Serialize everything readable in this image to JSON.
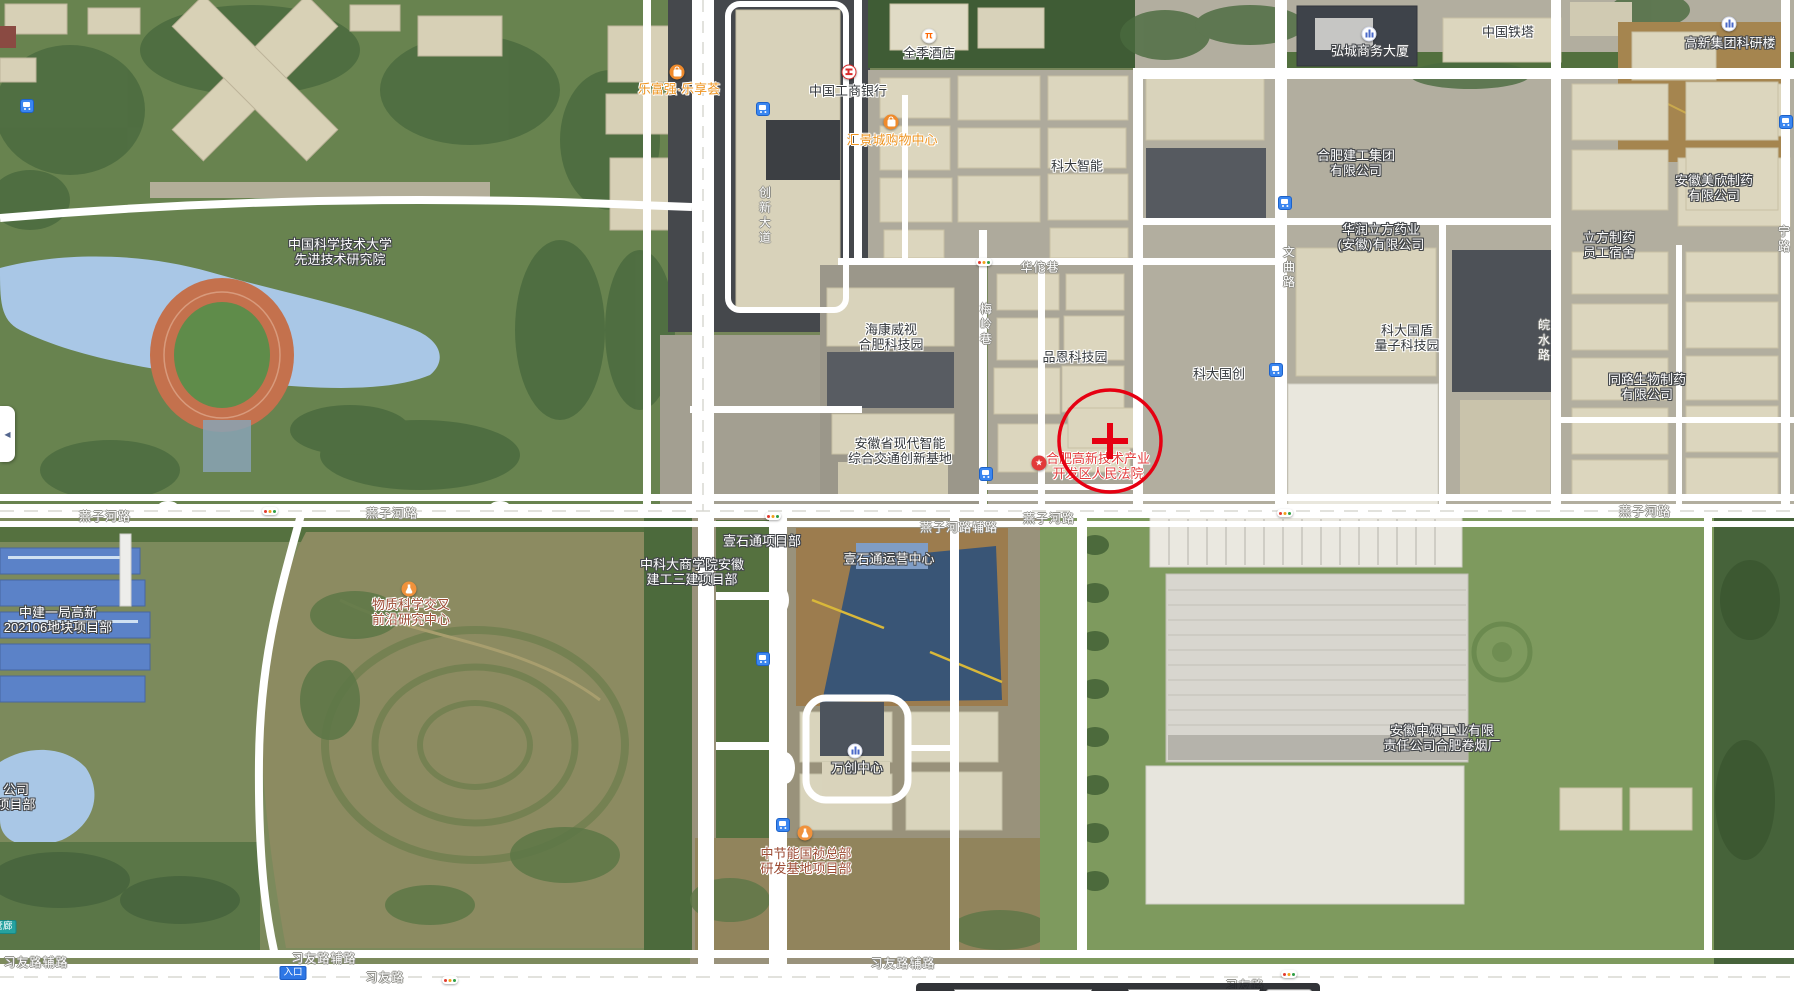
{
  "map": {
    "controls": {
      "collapse_arrow": "◀"
    },
    "marker": {
      "x": 1110,
      "y": 441,
      "r": 51
    },
    "bottom_bar": {
      "lng_label": "经度",
      "lng_value": "117.1978979979597",
      "lat_label": "纬度",
      "lat_value": "31.82598845471594",
      "search_button": "查询"
    },
    "pois": [
      {
        "id": "lefuqiang-mall",
        "lines": [
          "乐富强·乐享荟"
        ],
        "x": 679,
        "y": 89,
        "color": "orange",
        "icon": "shopping",
        "icon_x": 677,
        "icon_y": 72
      },
      {
        "id": "quanji-hotel",
        "lines": [
          "全季酒店"
        ],
        "x": 929,
        "y": 53,
        "color": "dark",
        "icon": "hotel",
        "icon_x": 929,
        "icon_y": 36
      },
      {
        "id": "icbc-bank",
        "lines": [
          "中国工商银行"
        ],
        "x": 848,
        "y": 91,
        "color": "dark",
        "icon": "bank",
        "icon_x": 849,
        "icon_y": 72
      },
      {
        "id": "huijing-mall",
        "lines": [
          "汇景城购物中心"
        ],
        "x": 892,
        "y": 140,
        "color": "orange",
        "icon": "shopping",
        "icon_x": 891,
        "icon_y": 122
      },
      {
        "id": "keda-zhineng",
        "lines": [
          "科大智能"
        ],
        "x": 1077,
        "y": 166,
        "color": "dark"
      },
      {
        "id": "hongcheng-tower",
        "lines": [
          "弘城商务大厦"
        ],
        "x": 1370,
        "y": 51,
        "color": "white",
        "icon": "building",
        "icon_x": 1369,
        "icon_y": 34
      },
      {
        "id": "china-tower",
        "lines": [
          "中国铁塔"
        ],
        "x": 1508,
        "y": 32,
        "color": "dark"
      },
      {
        "id": "gaoxin-keyan-building",
        "lines": [
          "高新集团科研楼"
        ],
        "x": 1730,
        "y": 43,
        "color": "white",
        "icon": "building",
        "icon_x": 1729,
        "icon_y": 24
      },
      {
        "id": "hefei-jiangong-group",
        "lines": [
          "合肥建工集团",
          "有限公司"
        ],
        "x": 1356,
        "y": 163,
        "color": "white"
      },
      {
        "id": "huarun-lifang-pharma",
        "lines": [
          "华润立方药业",
          "(安徽)有限公司"
        ],
        "x": 1381,
        "y": 237,
        "color": "white"
      },
      {
        "id": "lifang-dormitory",
        "lines": [
          "立方制药",
          "员工宿舍"
        ],
        "x": 1609,
        "y": 245,
        "color": "white"
      },
      {
        "id": "meixin-pharma",
        "lines": [
          "安徽美欣制药",
          "有限公司"
        ],
        "x": 1714,
        "y": 188,
        "color": "white"
      },
      {
        "id": "ustc-institute",
        "lines": [
          "中国科学技术大学",
          "先进技术研究院"
        ],
        "x": 340,
        "y": 252,
        "color": "white"
      },
      {
        "id": "hikvision-park",
        "lines": [
          "海康威视",
          "合肥科技园"
        ],
        "x": 891,
        "y": 337,
        "color": "dark"
      },
      {
        "id": "pinen-tech-park",
        "lines": [
          "品恩科技园"
        ],
        "x": 1075,
        "y": 357,
        "color": "dark"
      },
      {
        "id": "keda-guochuang",
        "lines": [
          "科大国创"
        ],
        "x": 1219,
        "y": 374,
        "color": "dark"
      },
      {
        "id": "guodun-quantum-park",
        "lines": [
          "科大国盾",
          "量子科技园"
        ],
        "x": 1407,
        "y": 338,
        "color": "dark"
      },
      {
        "id": "tonglu-bio",
        "lines": [
          "同路生物制药",
          "有限公司"
        ],
        "x": 1647,
        "y": 387,
        "color": "white"
      },
      {
        "id": "anhui-jiaotong-base",
        "lines": [
          "安徽省现代智能",
          "综合交通创新基地"
        ],
        "x": 900,
        "y": 451,
        "color": "dark"
      },
      {
        "id": "gaoxin-court",
        "lines": [
          "合肥高新技术产业",
          "开发区人民法院"
        ],
        "x": 1098,
        "y": 466,
        "color": "red",
        "icon": "star",
        "icon_x": 1039,
        "icon_y": 463
      },
      {
        "id": "wuzhi-science-center",
        "lines": [
          "物质科学交叉",
          "前沿研究中心"
        ],
        "x": 411,
        "y": 612,
        "color": "maroon",
        "icon": "flask",
        "icon_x": 409,
        "icon_y": 589
      },
      {
        "id": "zhongjian-project",
        "lines": [
          "中建一局高新",
          "202106地块项目部"
        ],
        "x": 58,
        "y": 620,
        "color": "white"
      },
      {
        "id": "keshang-project",
        "lines": [
          "中科大商学院安徽",
          "建工三建项目部"
        ],
        "x": 692,
        "y": 572,
        "color": "white"
      },
      {
        "id": "yishitong-project",
        "lines": [
          "壹石通项目部"
        ],
        "x": 762,
        "y": 541,
        "color": "white"
      },
      {
        "id": "yishitong-ops-center",
        "lines": [
          "壹石通运营中心"
        ],
        "x": 889,
        "y": 559,
        "color": "white"
      },
      {
        "id": "wanchuang-center",
        "lines": [
          "万创中心"
        ],
        "x": 857,
        "y": 768,
        "color": "white",
        "icon": "building",
        "icon_x": 855,
        "icon_y": 751
      },
      {
        "id": "zhongjieneng-project",
        "lines": [
          "中节能国祯总部",
          "研发基地项目部"
        ],
        "x": 806,
        "y": 861,
        "color": "maroon",
        "icon": "flask",
        "icon_x": 805,
        "icon_y": 833
      },
      {
        "id": "zhongyan-cigarette-factory",
        "lines": [
          "安徽中烟工业有限",
          "责任公司合肥卷烟厂"
        ],
        "x": 1442,
        "y": 738,
        "color": "white"
      },
      {
        "id": "left-edge-fragment",
        "lines": [
          "公司",
          "项目部"
        ],
        "x": 16,
        "y": 797,
        "color": "white"
      }
    ],
    "road_labels": [
      {
        "text": "燕子河路",
        "x": 105,
        "y": 516,
        "dir": "h"
      },
      {
        "text": "燕子河路",
        "x": 392,
        "y": 513,
        "dir": "h"
      },
      {
        "text": "燕子河路",
        "x": 1049,
        "y": 518,
        "dir": "h"
      },
      {
        "text": "燕子河路",
        "x": 1645,
        "y": 511,
        "dir": "h"
      },
      {
        "text": "燕子河路辅路",
        "x": 959,
        "y": 527,
        "dir": "h"
      },
      {
        "text": "华佗巷",
        "x": 1040,
        "y": 267,
        "dir": "h"
      },
      {
        "text": "创新大道",
        "x": 765,
        "y": 216,
        "dir": "v"
      },
      {
        "text": "梅岭巷",
        "x": 986,
        "y": 325,
        "dir": "v"
      },
      {
        "text": "文曲路",
        "x": 1289,
        "y": 268,
        "dir": "v"
      },
      {
        "text": "皖水路",
        "x": 1544,
        "y": 341,
        "dir": "v"
      },
      {
        "text": "宁路",
        "x": 1784,
        "y": 240,
        "dir": "v"
      },
      {
        "text": "习友路辅路",
        "x": 36,
        "y": 962,
        "dir": "h"
      },
      {
        "text": "习友路辅路",
        "x": 324,
        "y": 958,
        "dir": "h"
      },
      {
        "text": "习友路辅路",
        "x": 903,
        "y": 963,
        "dir": "h"
      },
      {
        "text": "习友路",
        "x": 385,
        "y": 977,
        "dir": "h"
      },
      {
        "text": "习友路",
        "x": 1245,
        "y": 985,
        "dir": "h"
      }
    ],
    "bus_stops": [
      {
        "x": 27,
        "y": 106
      },
      {
        "x": 763,
        "y": 109
      },
      {
        "x": 1285,
        "y": 203
      },
      {
        "x": 1786,
        "y": 122
      },
      {
        "x": 1276,
        "y": 370
      },
      {
        "x": 986,
        "y": 474
      },
      {
        "x": 763,
        "y": 659
      },
      {
        "x": 783,
        "y": 825
      }
    ],
    "traffic_lights": [
      {
        "x": 984,
        "y": 262
      },
      {
        "x": 270,
        "y": 511
      },
      {
        "x": 773,
        "y": 516
      },
      {
        "x": 1285,
        "y": 513
      },
      {
        "x": 450,
        "y": 980
      },
      {
        "x": 1289,
        "y": 974
      }
    ],
    "badges": [
      {
        "id": "entrance",
        "text": "入口",
        "style": "blue",
        "x": 293,
        "y": 973
      },
      {
        "id": "pipe-gallery",
        "text": "管廊",
        "style": "teal",
        "x": 3,
        "y": 927
      }
    ],
    "colors": {
      "road": "#ffffff",
      "water": "#a9c7e6",
      "marker_red": "#e60012",
      "bus_blue": "#3a86f0",
      "poi_orange": "#ee9522",
      "poi_red": "#e23c3c",
      "poi_maroon": "#9c4a33",
      "label_dark": "#33373b"
    }
  }
}
